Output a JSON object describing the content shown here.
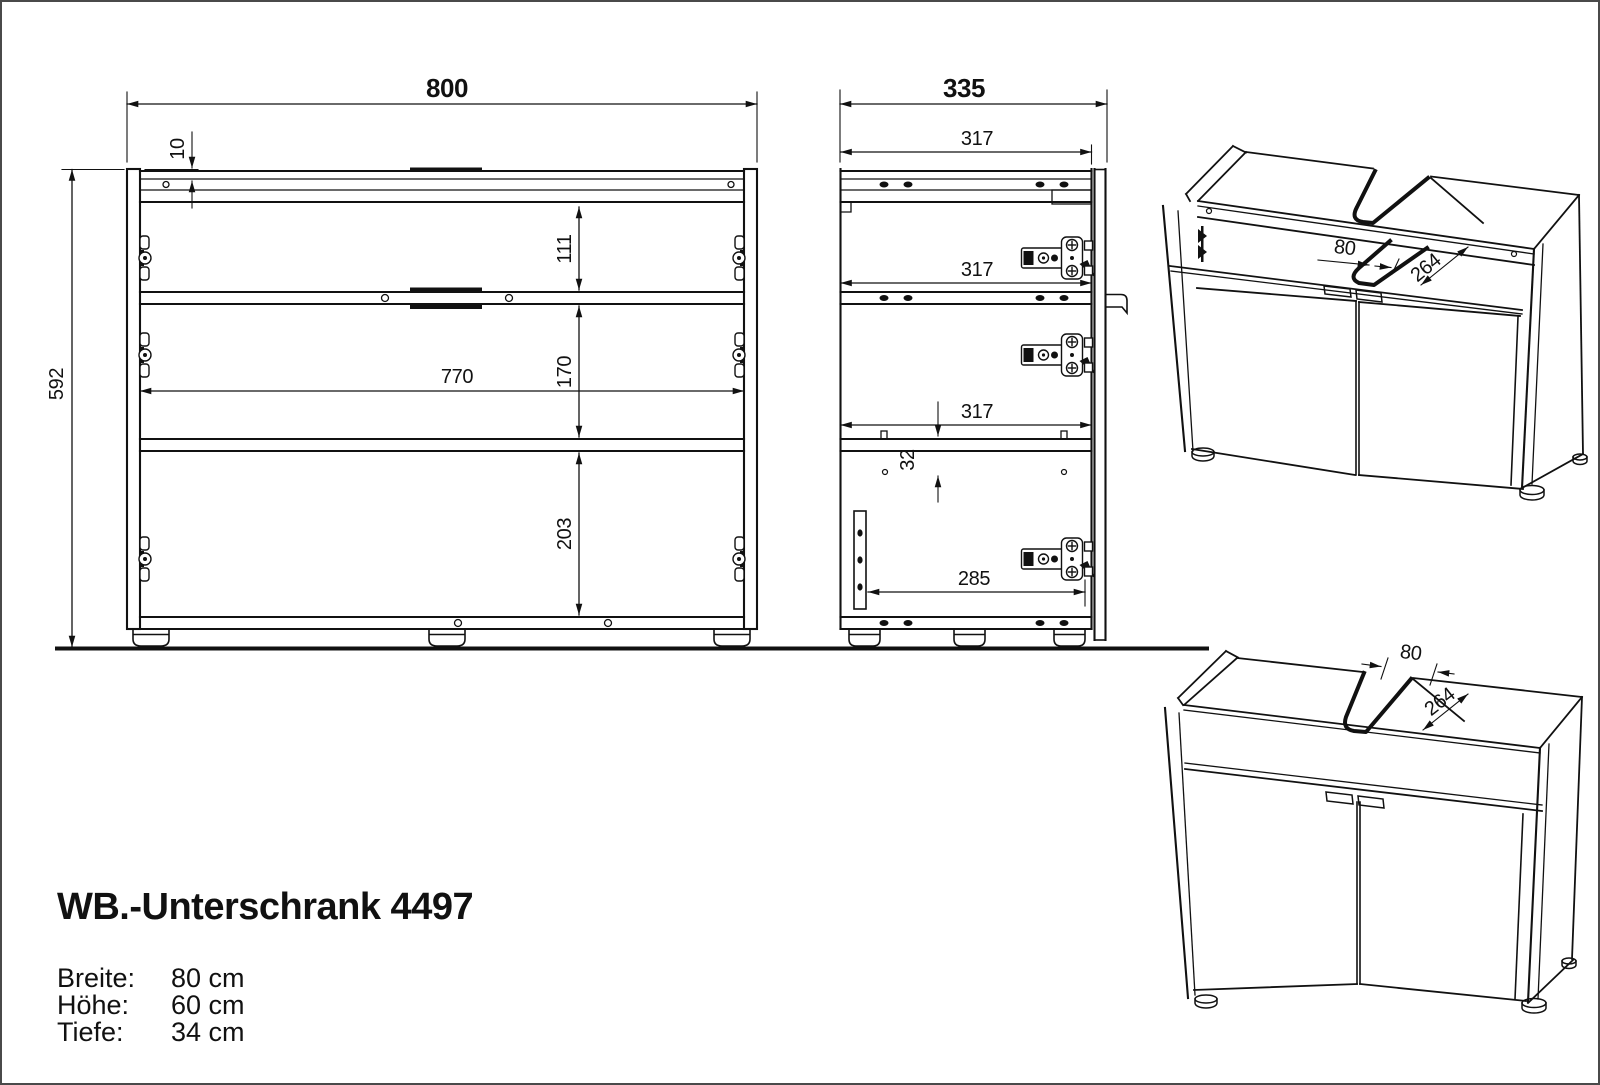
{
  "page": {
    "title": "WB.-Unterschrank 4497"
  },
  "specs": [
    {
      "label": "Breite:",
      "value": "80 cm"
    },
    {
      "label": "Höhe:",
      "value": "60 cm"
    },
    {
      "label": "Tiefe:",
      "value": "34 cm"
    }
  ],
  "front_view": {
    "width": "800",
    "height": "592",
    "top_inset": "10",
    "upper_gap": "111",
    "middle_gap": "170",
    "inner_width": "770",
    "lower_gap": "203"
  },
  "side_view": {
    "depth": "335",
    "rail_depth_top": "317",
    "rail_depth_mid": "317",
    "rail_depth_low": "317",
    "hole_offset": "32",
    "base_depth": "285"
  },
  "iso_top_view": {
    "cutout_width": "80",
    "cutout_depth": "264"
  },
  "iso_front_view": {
    "cutout_width": "80",
    "cutout_depth": "264"
  }
}
